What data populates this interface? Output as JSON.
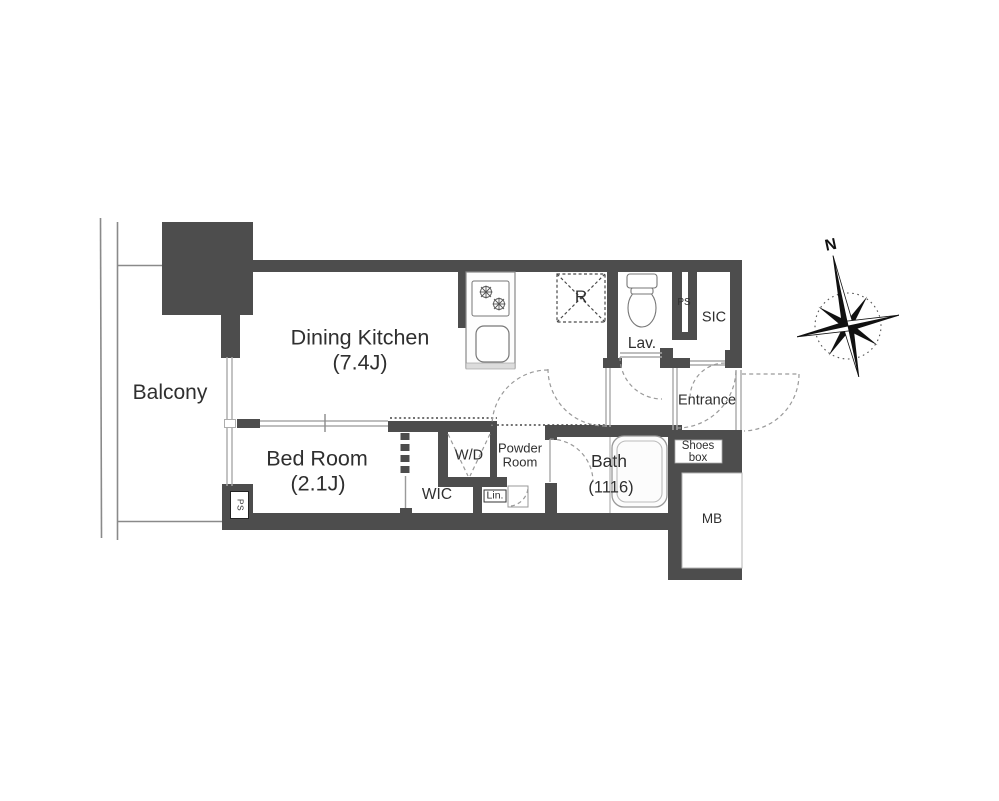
{
  "rooms": {
    "balcony": {
      "label": "Balcony"
    },
    "dining_kitchen": {
      "label": "Dining Kitchen",
      "size": "(7.4J)"
    },
    "bed_room": {
      "label": "Bed Room",
      "size": "(2.1J)"
    },
    "washer_dryer": {
      "label": "W/D"
    },
    "walk_in_closet": {
      "label": "WIC"
    },
    "linen_closet": {
      "label": "Lin."
    },
    "powder_room": {
      "label_line1": "Powder",
      "label_line2": "Room"
    },
    "bath": {
      "label": "Bath",
      "size": "(1116)"
    },
    "refrigerator_space": {
      "label": "R"
    },
    "lavatory": {
      "label": "Lav."
    },
    "pipe_space": {
      "label": "PS"
    },
    "bedroom_pipe_space": {
      "label": "PS"
    },
    "shoe_in_closet": {
      "label": "SIC"
    },
    "entrance": {
      "label": "Entrance"
    },
    "shoes_box": {
      "label_line1": "Shoes",
      "label_line2": "box"
    },
    "meter_box": {
      "label": "MB"
    }
  },
  "compass": {
    "north_label": "N"
  },
  "colors": {
    "wall": "#4d4d4d",
    "thin_line": "#8a8a8a",
    "text": "#2f2f2f",
    "background": "#ffffff"
  }
}
